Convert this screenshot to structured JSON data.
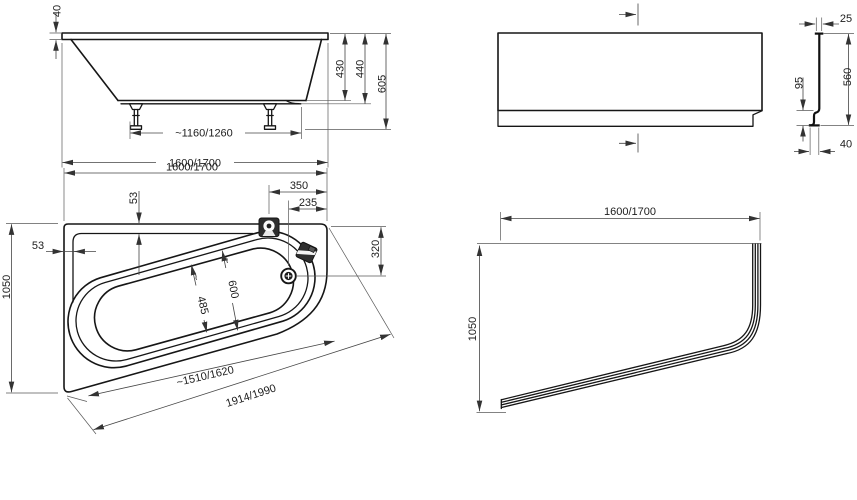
{
  "document": {
    "background": "#ffffff",
    "line_color": "#161616",
    "dimension_color": "#454545"
  },
  "views": {
    "bath_side": {
      "dims": {
        "rim_height": "40",
        "inner_depth": "430",
        "outer_depth": "440",
        "total_height": "605",
        "feet_span": "~1160/1260",
        "length": "1600/1700"
      }
    },
    "apron_front": {
      "dims": {
        "top_thickness": "25",
        "height": "560",
        "base_height": "95",
        "base_depth": "40"
      }
    },
    "bath_plan": {
      "dims": {
        "length": "1600/1700",
        "width": "1050",
        "mixer_offset": "350",
        "drain_offset": "235",
        "rim_offset_top": "53",
        "rim_offset_left": "53",
        "corner_side": "320",
        "approx_mark": "~",
        "basin_width_inner": "485",
        "basin_width_outer": "600",
        "front_edge_inner": "~1510/1620",
        "front_edge_outer": "1914/1990"
      }
    },
    "panel_plan": {
      "dims": {
        "length": "1600/1700",
        "width": "1050"
      }
    }
  }
}
